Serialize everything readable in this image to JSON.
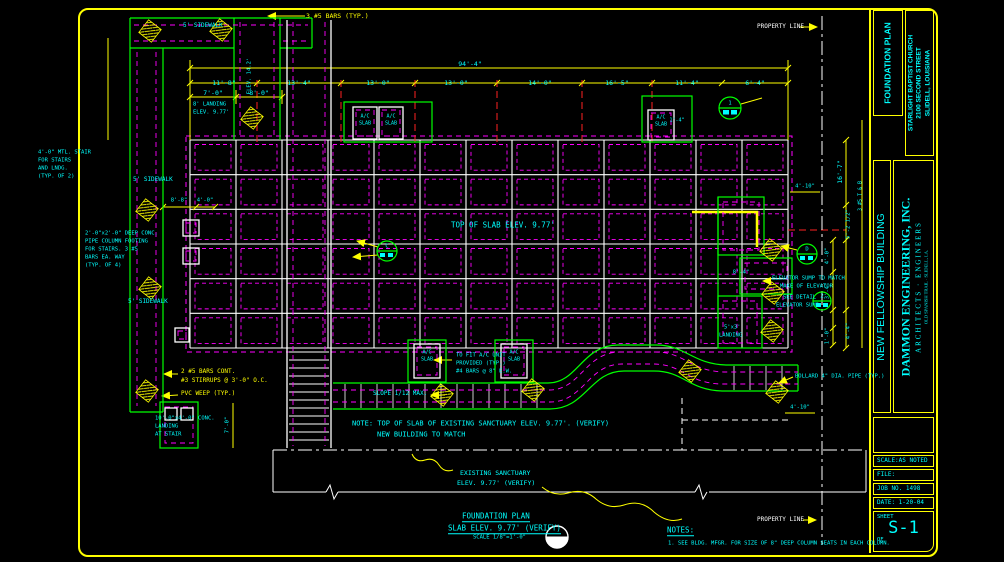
{
  "colors": {
    "cyan": "#00ffff",
    "yellow": "#ffff00",
    "white": "#ffffff",
    "green": "#00ff00",
    "magenta": "#ff00ff",
    "red": "#ff2222"
  },
  "title_block": {
    "project_type": "FOUNDATION PLAN",
    "client_lines": [
      "STARLIGHT BAPTIST CHURCH",
      "2100 SECOND STREET",
      "SLIDELL, LOUISIANA"
    ],
    "building_name": "NEW FELLOWSHIP BUILDING",
    "firm_name": "DAMMON ENGINEERING, INC.",
    "firm_subtitle": "ARCHITECTS · ENGINEERS",
    "firm_address": "OLD SPANISH TRAIL · SLIDELL, LA.",
    "scale": "SCALE:AS NOTED",
    "file": "FILE:",
    "job_no": "JOB NO. 1498",
    "date": "DATE: 1-20-04",
    "sheet_word": "SHEET",
    "sheet_no": "S-1",
    "of_word": "OF"
  },
  "labels": [
    {
      "n": "dim-overall-width",
      "t": "94'-4\"",
      "x": 470,
      "y": 64,
      "ctr": 1
    },
    {
      "n": "dim-bay",
      "t": "11'-8\"",
      "x": 224,
      "y": 83,
      "ctr": 1
    },
    {
      "n": "dim-bay",
      "t": "13'-4\"",
      "x": 299,
      "y": 83,
      "ctr": 1
    },
    {
      "n": "dim-bay",
      "t": "13'-0\"",
      "x": 378,
      "y": 83,
      "ctr": 1
    },
    {
      "n": "dim-bay",
      "t": "13'-0\"",
      "x": 456,
      "y": 83,
      "ctr": 1
    },
    {
      "n": "dim-bay",
      "t": "14'-0\"",
      "x": 540,
      "y": 83,
      "ctr": 1
    },
    {
      "n": "dim-bay",
      "t": "16'-5\"",
      "x": 617,
      "y": 83,
      "ctr": 1
    },
    {
      "n": "dim-bay",
      "t": "11'-4\"",
      "x": 687,
      "y": 83,
      "ctr": 1
    },
    {
      "n": "dim-bay",
      "t": "6'-4\"",
      "x": 755,
      "y": 83,
      "ctr": 1
    },
    {
      "n": "dim-sub",
      "t": "7'-0\"",
      "x": 213,
      "y": 93,
      "ctr": 1
    },
    {
      "n": "dim-sub",
      "t": "8'-0\"",
      "x": 259,
      "y": 93,
      "ctr": 1
    },
    {
      "n": "dim-small",
      "t": "8'-8\"",
      "x": 179,
      "y": 201,
      "fs": 5.5,
      "ctr": 1
    },
    {
      "n": "dim-small",
      "t": "4'-0\"",
      "x": 205,
      "y": 201,
      "fs": 5.5,
      "ctr": 1
    },
    {
      "n": "dim-small",
      "t": "1'-4\"",
      "x": 677,
      "y": 121,
      "fs": 5,
      "ctr": 1
    },
    {
      "n": "dim-small",
      "t": "4'-10\"",
      "x": 805,
      "y": 187,
      "fs": 5.5,
      "ctr": 1
    },
    {
      "n": "dim-small",
      "t": "4'-10\"",
      "x": 800,
      "y": 408,
      "fs": 5.5,
      "ctr": 1
    },
    {
      "n": "dim-vert",
      "t": "16'-7\"",
      "x": 840,
      "y": 172,
      "r": -90,
      "ctr": 1
    },
    {
      "n": "dim-vert",
      "t": "5'-2 1/2\"",
      "x": 849,
      "y": 224,
      "fs": 5.5,
      "r": -90,
      "ctr": 1
    },
    {
      "n": "dim-vert",
      "t": "4'-4\"",
      "x": 849,
      "y": 331,
      "fs": 5.5,
      "r": -90,
      "ctr": 1
    },
    {
      "n": "dim-vert",
      "t": "4'-0\"",
      "x": 828,
      "y": 256,
      "fs": 5.5,
      "r": -90,
      "ctr": 1
    },
    {
      "n": "dim-vert",
      "t": "3'-4\"",
      "x": 828,
      "y": 291,
      "fs": 5.5,
      "r": -90,
      "ctr": 1
    },
    {
      "n": "dim-vert",
      "t": "1'-0\"",
      "x": 828,
      "y": 336,
      "fs": 5.5,
      "r": -90,
      "ctr": 1
    },
    {
      "n": "dim-small",
      "t": "8'-4\"",
      "x": 741,
      "y": 273,
      "fs": 5.5,
      "ctr": 1
    },
    {
      "n": "note-bars-tb",
      "t": "3 #5 T & B",
      "x": 861,
      "y": 196,
      "fs": 5,
      "r": -90,
      "ctr": 1
    },
    {
      "n": "note-bars-typ",
      "t": "3 #5 BARS (TYP.)",
      "x": 306,
      "y": 16,
      "c": "yellow"
    },
    {
      "n": "note-bars-cont",
      "t": "2 #5 BARS CONT.",
      "x": 181,
      "y": 372,
      "c": "yellow",
      "fs": 6
    },
    {
      "n": "note-stirrups",
      "t": "#3 STIRRUPS @ 3'-0\" O.C.",
      "x": 181,
      "y": 381,
      "c": "yellow",
      "fs": 6
    },
    {
      "n": "note-pvc-weep",
      "t": "PVC WEEP (TYP.)",
      "x": 181,
      "y": 394,
      "c": "yellow",
      "fs": 6
    },
    {
      "n": "property-line-label",
      "t": "PROPERTY LINE",
      "x": 757,
      "y": 27,
      "c": "white",
      "fs": 6
    },
    {
      "n": "property-line-label",
      "t": "PROPERTY LINE",
      "x": 757,
      "y": 520,
      "c": "white",
      "fs": 6
    },
    {
      "n": "sidewalk-label",
      "t": "5' SIDEWALK",
      "x": 183,
      "y": 26,
      "fs": 6
    },
    {
      "n": "sidewalk-label",
      "t": "5' SIDEWALK",
      "x": 133,
      "y": 180,
      "fs": 6
    },
    {
      "n": "sidewalk-label",
      "t": "5' SIDEWALK",
      "x": 128,
      "y": 302,
      "fs": 6
    },
    {
      "n": "elev-label",
      "t": "ELEV. 14.2'",
      "x": 250,
      "y": 76,
      "fs": 5.5,
      "r": -90,
      "ctr": 1
    },
    {
      "n": "landing-label",
      "t": "8' LANDING",
      "x": 193,
      "y": 105,
      "fs": 5.5
    },
    {
      "n": "landing-label",
      "t": "ELEV. 9.77'",
      "x": 193,
      "y": 113,
      "fs": 5.5
    },
    {
      "n": "stair-note",
      "t": "4'-0\" MTL. STAIR",
      "x": 38,
      "y": 153,
      "fs": 5.5
    },
    {
      "n": "stair-note",
      "t": "FOR STAIRS",
      "x": 38,
      "y": 161,
      "fs": 5.5
    },
    {
      "n": "stair-note",
      "t": "AND LNDG.",
      "x": 38,
      "y": 169,
      "fs": 5.5
    },
    {
      "n": "stair-note",
      "t": "(TYP. OF 2)",
      "x": 38,
      "y": 177,
      "fs": 5.5
    },
    {
      "n": "footing-note",
      "t": "2'-0\"x2'-0\" DEEP CONC.",
      "x": 85,
      "y": 234,
      "fs": 5.5
    },
    {
      "n": "footing-note",
      "t": "PIPE COLUMN FOOTING",
      "x": 85,
      "y": 242,
      "fs": 5.5
    },
    {
      "n": "footing-note",
      "t": "FOR STAIRS. 3 #5",
      "x": 85,
      "y": 250,
      "fs": 5.5
    },
    {
      "n": "footing-note",
      "t": "BARS EA. WAY",
      "x": 85,
      "y": 258,
      "fs": 5.5
    },
    {
      "n": "footing-note",
      "t": "(TYP. OF 4)",
      "x": 85,
      "y": 266,
      "fs": 5.5
    },
    {
      "n": "landing-note",
      "t": "10'-0\"x4'-0\" CONC.",
      "x": 155,
      "y": 419,
      "fs": 5.5
    },
    {
      "n": "landing-note",
      "t": "LANDING",
      "x": 155,
      "y": 427,
      "fs": 5.5
    },
    {
      "n": "landing-note",
      "t": "AT STAIR",
      "x": 155,
      "y": 435,
      "fs": 5.5
    },
    {
      "n": "dim-vert",
      "t": "7'-0\"",
      "x": 228,
      "y": 425,
      "fs": 5.5,
      "r": -90,
      "ctr": 1
    },
    {
      "n": "slope-note",
      "t": "SLOPE 1/12 MAX.",
      "x": 373,
      "y": 394,
      "fs": 6
    },
    {
      "n": "ac-note",
      "t": "TO FIT A/C UNIT",
      "x": 456,
      "y": 356,
      "fs": 5.5
    },
    {
      "n": "ac-note",
      "t": "PROVIDED (TYP.)",
      "x": 456,
      "y": 364,
      "fs": 5.5
    },
    {
      "n": "ac-note",
      "t": "#4 BARS @ 8\" E.W.",
      "x": 456,
      "y": 372,
      "fs": 5.5
    },
    {
      "n": "ac-slab-label",
      "t": "A/C",
      "x": 365,
      "y": 117,
      "fs": 5,
      "ctr": 1
    },
    {
      "n": "ac-slab-label",
      "t": "SLAB",
      "x": 365,
      "y": 124,
      "fs": 5,
      "ctr": 1
    },
    {
      "n": "ac-slab-label",
      "t": "A/C",
      "x": 391,
      "y": 117,
      "fs": 5,
      "ctr": 1
    },
    {
      "n": "ac-slab-label",
      "t": "SLAB",
      "x": 391,
      "y": 124,
      "fs": 5,
      "ctr": 1
    },
    {
      "n": "ac-slab-label",
      "t": "A/C",
      "x": 661,
      "y": 118,
      "fs": 5,
      "ctr": 1
    },
    {
      "n": "ac-slab-label",
      "t": "SLAB",
      "x": 661,
      "y": 125,
      "fs": 5,
      "ctr": 1
    },
    {
      "n": "ac-slab-label",
      "t": "A/C",
      "x": 427,
      "y": 353,
      "fs": 5,
      "ctr": 1
    },
    {
      "n": "ac-slab-label",
      "t": "SLAB",
      "x": 427,
      "y": 360,
      "fs": 5,
      "ctr": 1
    },
    {
      "n": "ac-slab-label",
      "t": "A/C",
      "x": 514,
      "y": 353,
      "fs": 5,
      "ctr": 1
    },
    {
      "n": "ac-slab-label",
      "t": "SLAB",
      "x": 514,
      "y": 360,
      "fs": 5,
      "ctr": 1
    },
    {
      "n": "elevator-note",
      "t": "ELEVATOR SUMP TO MATCH",
      "x": 772,
      "y": 279,
      "fs": 5.5
    },
    {
      "n": "elevator-note",
      "t": "MAKE OF ELEVATOR",
      "x": 780,
      "y": 287,
      "fs": 5.5
    },
    {
      "n": "elevator-note",
      "t": "SEE DETAIL",
      "x": 783,
      "y": 298,
      "fs": 5.5
    },
    {
      "n": "elevator-note",
      "t": "ELEVATOR SUMP",
      "x": 776,
      "y": 306,
      "fs": 5.5
    },
    {
      "n": "landing-note",
      "t": "5'x3'",
      "x": 724,
      "y": 328,
      "fs": 5.5
    },
    {
      "n": "landing-note",
      "t": "LANDING",
      "x": 719,
      "y": 336,
      "fs": 5.5
    },
    {
      "n": "bollard-note",
      "t": "BOLLARD 4\" DIA. PIPE (TYP.)",
      "x": 795,
      "y": 377,
      "fs": 5.5
    },
    {
      "n": "slab-elev-label",
      "t": "TOP OF SLAB ELEV. 9.77'",
      "x": 451,
      "y": 225,
      "fs": 7.5
    },
    {
      "n": "sanctuary-note",
      "t": "NOTE: TOP OF SLAB OF EXISTING SANCTUARY ELEV. 9.77'. (VERIFY)",
      "x": 352,
      "y": 424,
      "fs": 7
    },
    {
      "n": "sanctuary-note",
      "t": "NEW BUILDING TO MATCH",
      "x": 377,
      "y": 435,
      "fs": 7
    },
    {
      "n": "existing-sanctuary-label",
      "t": "EXISTING SANCTUARY",
      "x": 460,
      "y": 473,
      "fs": 6.5
    },
    {
      "n": "existing-sanctuary-label",
      "t": "ELEV. 9.77' (VERIFY)",
      "x": 457,
      "y": 483,
      "fs": 6.5
    },
    {
      "n": "drawing-title",
      "t": "FOUNDATION PLAN",
      "x": 462,
      "y": 517,
      "fs": 7.5,
      "u": 1
    },
    {
      "n": "drawing-subtitle",
      "t": "SLAB ELEV. 9.77' (VERIFY)",
      "x": 448,
      "y": 529,
      "fs": 7.5,
      "u": 1
    },
    {
      "n": "drawing-scale",
      "t": "SCALE 1/8\"=1'-0\"",
      "x": 473,
      "y": 538,
      "fs": 5.5
    },
    {
      "n": "notes-heading",
      "t": "NOTES:",
      "x": 667,
      "y": 531,
      "fs": 7.5,
      "u": 1
    },
    {
      "n": "note-1",
      "t": "1. SEE BLDG. MFGR. FOR SIZE OF 8\" DEEP COLUMN SEATS IN EACH COLUMN.",
      "x": 668,
      "y": 544,
      "fs": 5.5
    },
    {
      "n": "detail-marker-label",
      "t": "1",
      "x": 730,
      "y": 104,
      "fs": 5.5,
      "ctr": 1
    },
    {
      "n": "detail-marker-label",
      "t": "C",
      "x": 387,
      "y": 247,
      "fs": 5.5,
      "ctr": 1
    },
    {
      "n": "detail-marker-label",
      "t": "D",
      "x": 807,
      "y": 250,
      "fs": 5.5,
      "ctr": 1
    },
    {
      "n": "detail-marker-label",
      "t": "2",
      "x": 822,
      "y": 297,
      "fs": 5.5,
      "ctr": 1
    }
  ]
}
